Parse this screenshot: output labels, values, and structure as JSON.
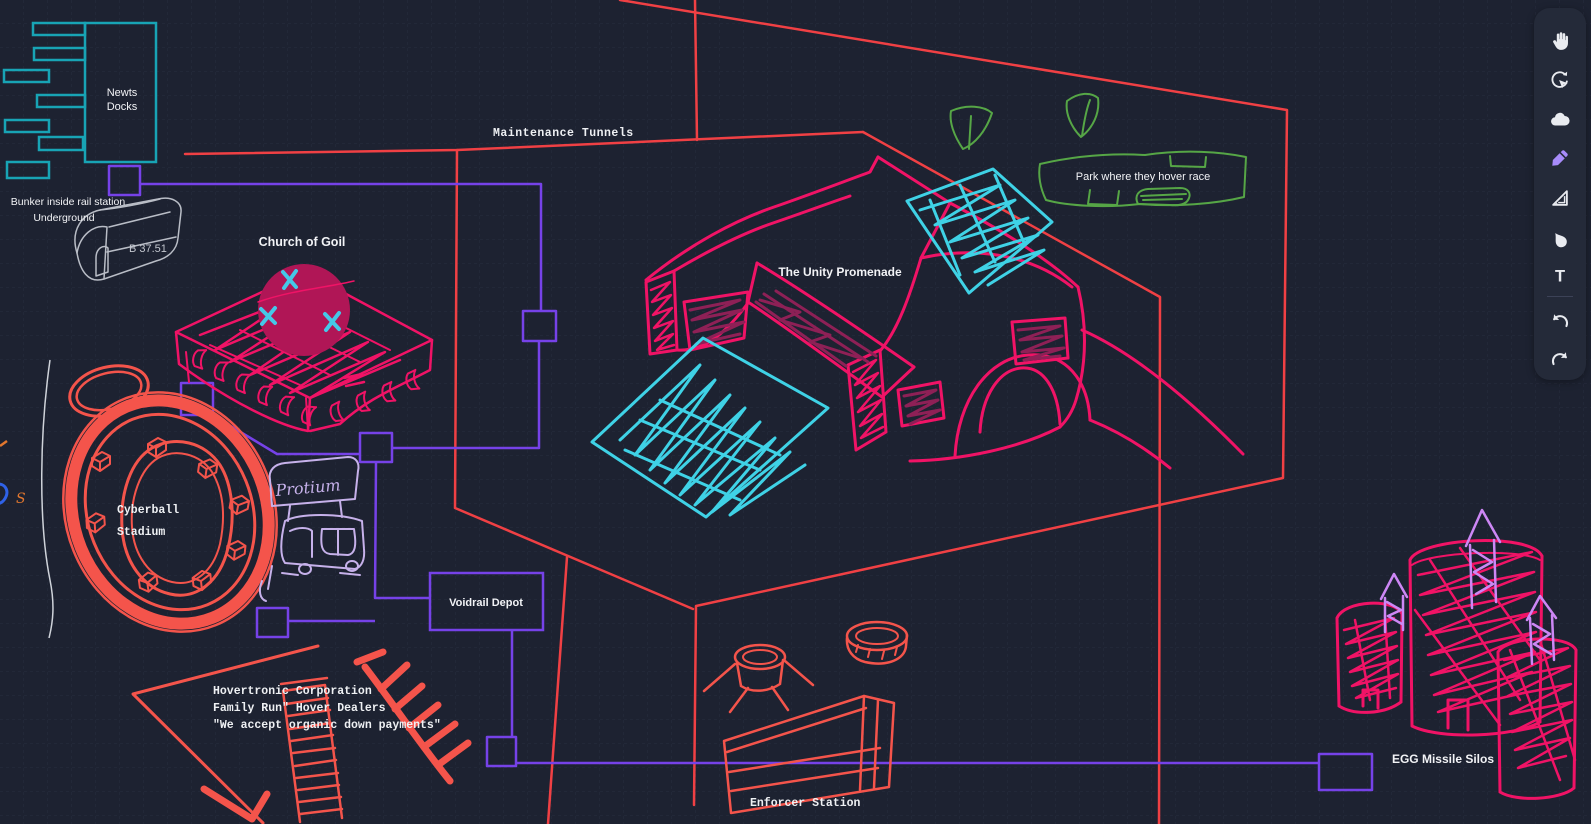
{
  "canvas": {
    "background": "#1d2231",
    "grid": "#282d3f"
  },
  "labels": {
    "newts_docks_line1": "Newts",
    "newts_docks_line2": "Docks",
    "bunker_line1": "Bunker inside rail station",
    "bunker_line2": "Underground",
    "bunker_code": "B 37.51",
    "maintenance_tunnels": "Maintenance Tunnels",
    "church_of_goil": "Church of Goil",
    "unity_promenade": "The Unity Promenade",
    "park_hover_race": "Park where they hover race",
    "cyberball_line1": "Cyberball",
    "cyberball_line2": "Stadium",
    "protium": "Protium",
    "voidrail_depot": "Voidrail Depot",
    "hovertronic_line1": "Hovertronic Corporation",
    "hovertronic_line2": "Family Run\" Hover Dealers",
    "hovertronic_line3": "\"We accept organic down payments\"",
    "enforcer_station": "Enforcer Station",
    "egg_missile_silos": "EGG Missile Silos",
    "edge_scribble": "S"
  },
  "toolbar": {
    "active_tool": "pen",
    "text_tool_glyph": "T",
    "tools": [
      "hand",
      "rotate-select",
      "cloud",
      "pen",
      "set-square",
      "droplet",
      "text",
      "undo",
      "redo"
    ]
  },
  "colors": {
    "boundary_red": "#f04044",
    "sketch_red": "#f4544b",
    "pink": "#f01366",
    "maroon_fill": "#b01656",
    "window_maroon": "#8e2056",
    "cyan": "#3fd2e6",
    "teal": "#18a4b5",
    "green": "#56a646",
    "connector_purple": "#7642e8",
    "missile_violet": "#cd87f5",
    "protium_lavender": "#c6b1ea",
    "sketch_gray": "#b9bdc6",
    "label_text": "#f2f3f6"
  }
}
